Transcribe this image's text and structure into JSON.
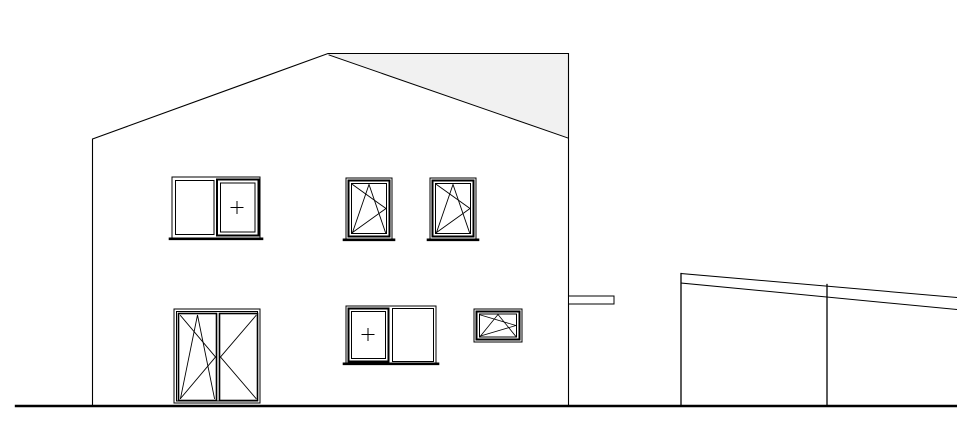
{
  "meta": {
    "title": "House side elevation with carport - CAD line drawing",
    "canvas_width": 957,
    "canvas_height": 421
  },
  "colors": {
    "background": "#ffffff",
    "line": "#000000",
    "roof_shade": "#f1f1f1"
  },
  "drawing": {
    "elements": [
      {
        "name": "house",
        "type": "group",
        "interactable": false,
        "children": [
          {
            "name": "roof-far-plane",
            "type": "polygon",
            "points": "328,54 568,54 568,138",
            "fill": "#f1f1f1",
            "sw": 0,
            "interactable": false
          },
          {
            "name": "roof-verge-line",
            "type": "line",
            "x1": 329,
            "y1": 55,
            "x2": 568,
            "y2": 138,
            "sw": 1,
            "interactable": false
          },
          {
            "name": "house-outline",
            "type": "polyline",
            "points": "92.5,406 92.5,139 328,53.5 568.5,53.5 568.5,406",
            "sw": 1.1,
            "interactable": false
          }
        ]
      },
      {
        "name": "window-upper-left",
        "type": "group",
        "interactable": false,
        "children": [
          {
            "name": "window-frame",
            "type": "rect",
            "x": 172,
            "y": 177,
            "w": 88,
            "h": 61,
            "sw": 1,
            "interactable": false
          },
          {
            "name": "fixed-pane",
            "type": "rect",
            "x": 175.5,
            "y": 180.5,
            "w": 38.5,
            "h": 54,
            "sw": 1,
            "interactable": false
          },
          {
            "name": "sash-outer",
            "type": "rect",
            "x": 217,
            "y": 179.5,
            "w": 41.5,
            "h": 56,
            "sw": 2,
            "interactable": false
          },
          {
            "name": "sash-inner",
            "type": "rect",
            "x": 220.5,
            "y": 183,
            "w": 34.5,
            "h": 49,
            "sw": 1,
            "interactable": false
          },
          {
            "name": "fixed-glazing-plus-h",
            "type": "line",
            "x1": 231,
            "y1": 207.5,
            "x2": 243,
            "y2": 207.5,
            "sw": 1,
            "interactable": false
          },
          {
            "name": "fixed-glazing-plus-v",
            "type": "line",
            "x1": 237,
            "y1": 201.5,
            "x2": 237,
            "y2": 213.5,
            "sw": 1,
            "interactable": false
          },
          {
            "name": "window-sill",
            "type": "line",
            "x1": 170,
            "y1": 238.8,
            "x2": 262,
            "y2": 238.8,
            "sw": 2.6,
            "interactable": false
          }
        ]
      },
      {
        "name": "window-upper-middle",
        "type": "group",
        "interactable": false,
        "children": [
          {
            "name": "window-frame",
            "type": "rect",
            "x": 346,
            "y": 178,
            "w": 46,
            "h": 61,
            "sw": 1,
            "interactable": false
          },
          {
            "name": "sash-outer",
            "type": "rect",
            "x": 348.5,
            "y": 180.5,
            "w": 41,
            "h": 56,
            "sw": 2,
            "interactable": false
          },
          {
            "name": "sash-inner",
            "type": "rect",
            "x": 351.5,
            "y": 183.5,
            "w": 35,
            "h": 50,
            "sw": 1,
            "interactable": false
          },
          {
            "name": "tilt-symbol",
            "type": "polyline",
            "points": "352.5,232.5 369,184.5 385.5,232.5",
            "sw": 0.9,
            "interactable": false
          },
          {
            "name": "turn-symbol-upper",
            "type": "line",
            "x1": 352.5,
            "y1": 184.5,
            "x2": 386,
            "y2": 208.5,
            "sw": 0.9,
            "interactable": false
          },
          {
            "name": "turn-symbol-lower",
            "type": "line",
            "x1": 352.5,
            "y1": 232.5,
            "x2": 386,
            "y2": 208.5,
            "sw": 0.9,
            "interactable": false
          },
          {
            "name": "window-sill",
            "type": "line",
            "x1": 344,
            "y1": 239.8,
            "x2": 394,
            "y2": 239.8,
            "sw": 2.6,
            "interactable": false
          }
        ]
      },
      {
        "name": "window-upper-right",
        "type": "group",
        "interactable": false,
        "children": [
          {
            "name": "window-frame",
            "type": "rect",
            "x": 430,
            "y": 178,
            "w": 46,
            "h": 61,
            "sw": 1,
            "interactable": false
          },
          {
            "name": "sash-outer",
            "type": "rect",
            "x": 432.5,
            "y": 180.5,
            "w": 41,
            "h": 56,
            "sw": 2,
            "interactable": false
          },
          {
            "name": "sash-inner",
            "type": "rect",
            "x": 435.5,
            "y": 183.5,
            "w": 35,
            "h": 50,
            "sw": 1,
            "interactable": false
          },
          {
            "name": "tilt-symbol",
            "type": "polyline",
            "points": "436.5,232.5 453,184.5 469.5,232.5",
            "sw": 0.9,
            "interactable": false
          },
          {
            "name": "turn-symbol-upper",
            "type": "line",
            "x1": 436.5,
            "y1": 184.5,
            "x2": 470,
            "y2": 208.5,
            "sw": 0.9,
            "interactable": false
          },
          {
            "name": "turn-symbol-lower",
            "type": "line",
            "x1": 436.5,
            "y1": 232.5,
            "x2": 470,
            "y2": 208.5,
            "sw": 0.9,
            "interactable": false
          },
          {
            "name": "window-sill",
            "type": "line",
            "x1": 428,
            "y1": 239.8,
            "x2": 478,
            "y2": 239.8,
            "sw": 2.6,
            "interactable": false
          }
        ]
      },
      {
        "name": "entrance-door",
        "type": "group",
        "interactable": false,
        "children": [
          {
            "name": "door-frame-outer",
            "type": "rect",
            "x": 174,
            "y": 309,
            "w": 86,
            "h": 94,
            "sw": 1,
            "interactable": false
          },
          {
            "name": "door-frame-inner",
            "type": "rect",
            "x": 176.5,
            "y": 311.5,
            "w": 81,
            "h": 89.5,
            "sw": 1,
            "interactable": false
          },
          {
            "name": "door-leaf-left",
            "type": "rect",
            "x": 178.5,
            "y": 313.5,
            "w": 38,
            "h": 87,
            "sw": 1.6,
            "interactable": false
          },
          {
            "name": "door-leaf-right",
            "type": "rect",
            "x": 219.5,
            "y": 313.5,
            "w": 38,
            "h": 87,
            "sw": 1.6,
            "interactable": false
          },
          {
            "name": "left-leaf-tilt-symbol",
            "type": "polyline",
            "points": "180.5,398.5 197.5,315 214.5,398.5",
            "sw": 0.9,
            "interactable": false
          },
          {
            "name": "left-leaf-turn-upper",
            "type": "line",
            "x1": 180.5,
            "y1": 315.5,
            "x2": 215.5,
            "y2": 357,
            "sw": 0.9,
            "interactable": false
          },
          {
            "name": "left-leaf-turn-lower",
            "type": "line",
            "x1": 180.5,
            "y1": 398.5,
            "x2": 215.5,
            "y2": 357,
            "sw": 0.9,
            "interactable": false
          },
          {
            "name": "right-leaf-turn-upper",
            "type": "line",
            "x1": 256,
            "y1": 315.5,
            "x2": 220.5,
            "y2": 357,
            "sw": 0.9,
            "interactable": false
          },
          {
            "name": "right-leaf-turn-lower",
            "type": "line",
            "x1": 256,
            "y1": 398.5,
            "x2": 220.5,
            "y2": 357,
            "sw": 0.9,
            "interactable": false
          }
        ]
      },
      {
        "name": "window-ground-middle",
        "type": "group",
        "interactable": false,
        "children": [
          {
            "name": "window-frame",
            "type": "rect",
            "x": 346,
            "y": 306,
            "w": 90,
            "h": 57,
            "sw": 1,
            "interactable": false
          },
          {
            "name": "sash-outer",
            "type": "rect",
            "x": 348.5,
            "y": 308.5,
            "w": 40,
            "h": 53,
            "sw": 2,
            "interactable": false
          },
          {
            "name": "sash-inner",
            "type": "rect",
            "x": 351.5,
            "y": 311.5,
            "w": 34,
            "h": 47,
            "sw": 1,
            "interactable": false
          },
          {
            "name": "fixed-glazing-plus-h",
            "type": "line",
            "x1": 362,
            "y1": 334.5,
            "x2": 374,
            "y2": 334.5,
            "sw": 1,
            "interactable": false
          },
          {
            "name": "fixed-glazing-plus-v",
            "type": "line",
            "x1": 368,
            "y1": 328.5,
            "x2": 368,
            "y2": 340.5,
            "sw": 1,
            "interactable": false
          },
          {
            "name": "fixed-pane",
            "type": "rect",
            "x": 392.5,
            "y": 308.5,
            "w": 41,
            "h": 53,
            "sw": 1,
            "interactable": false
          },
          {
            "name": "window-sill",
            "type": "line",
            "x1": 344,
            "y1": 363.8,
            "x2": 438,
            "y2": 363.8,
            "sw": 2.6,
            "interactable": false
          }
        ]
      },
      {
        "name": "window-ground-small",
        "type": "group",
        "interactable": false,
        "children": [
          {
            "name": "window-frame",
            "type": "rect",
            "x": 474,
            "y": 309,
            "w": 48,
            "h": 33,
            "sw": 1,
            "interactable": false
          },
          {
            "name": "sash-outer",
            "type": "rect",
            "x": 476.5,
            "y": 311.5,
            "w": 43,
            "h": 28,
            "sw": 2,
            "interactable": false
          },
          {
            "name": "sash-inner",
            "type": "rect",
            "x": 479.5,
            "y": 314,
            "w": 37,
            "h": 23,
            "sw": 1,
            "interactable": false
          },
          {
            "name": "tilt-symbol",
            "type": "polyline",
            "points": "480.5,336 498,314.5 515.5,336",
            "sw": 0.8,
            "interactable": false
          },
          {
            "name": "turn-symbol-upper",
            "type": "line",
            "x1": 480.5,
            "y1": 315,
            "x2": 516,
            "y2": 325.5,
            "sw": 0.8,
            "interactable": false
          },
          {
            "name": "turn-symbol-lower",
            "type": "line",
            "x1": 480.5,
            "y1": 336,
            "x2": 516,
            "y2": 325.5,
            "sw": 0.8,
            "interactable": false
          }
        ]
      },
      {
        "name": "canopy-beam",
        "type": "rect",
        "x": 568.5,
        "y": 296,
        "w": 45.5,
        "h": 8,
        "sw": 1,
        "fill": "#ffffff",
        "interactable": false
      },
      {
        "name": "carport",
        "type": "group",
        "interactable": false,
        "children": [
          {
            "name": "carport-post-left",
            "type": "line",
            "x1": 681,
            "y1": 273.5,
            "x2": 681,
            "y2": 406,
            "sw": 1.3,
            "interactable": false
          },
          {
            "name": "carport-post-right",
            "type": "line",
            "x1": 827,
            "y1": 284.5,
            "x2": 827,
            "y2": 406,
            "sw": 1.3,
            "interactable": false
          },
          {
            "name": "carport-roof-top-edge",
            "type": "line",
            "x1": 681,
            "y1": 273.5,
            "x2": 957,
            "y2": 297.5,
            "sw": 1,
            "interactable": false
          },
          {
            "name": "carport-roof-bottom-edge",
            "type": "line",
            "x1": 681,
            "y1": 283,
            "x2": 957,
            "y2": 309.5,
            "sw": 1,
            "interactable": false
          }
        ]
      },
      {
        "name": "ground-line",
        "type": "line",
        "x1": 16,
        "y1": 406,
        "x2": 957,
        "y2": 406,
        "sw": 2.4,
        "interactable": false
      }
    ]
  }
}
